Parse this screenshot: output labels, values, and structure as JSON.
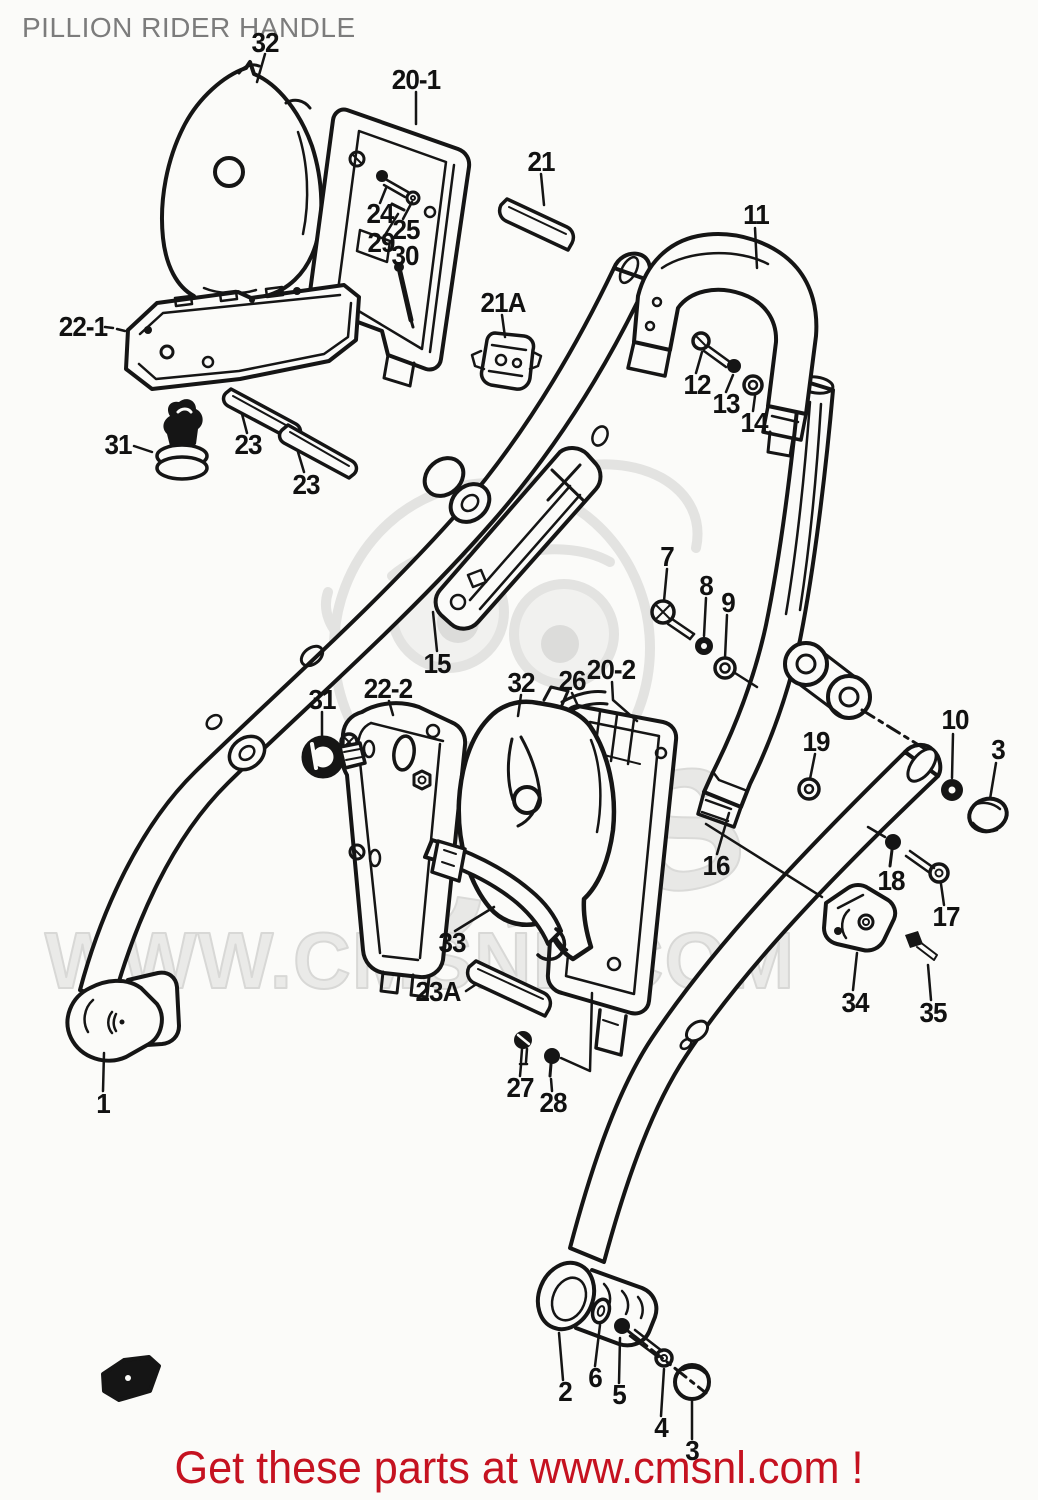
{
  "page": {
    "title": "PILLION RIDER HANDLE",
    "background": "#fbfbf9"
  },
  "colors": {
    "title_gray": "#7c7c7c",
    "line_black": "#151515",
    "footer_red": "#c51220",
    "watermark_gray": "#e4e4e2"
  },
  "watermark": {
    "logo_text": "CMS",
    "url_text": "WWW.CMSNL.COM"
  },
  "footer": {
    "text": "Get these parts at www.cmsnl.com !"
  },
  "diagram": {
    "description": "Exploded parts diagram of pillion rider handle assembly",
    "part_labels": [
      {
        "text": "32",
        "x": 265,
        "y": 43
      },
      {
        "text": "20-1",
        "x": 416,
        "y": 80
      },
      {
        "text": "24",
        "x": 380,
        "y": 214
      },
      {
        "text": "25",
        "x": 406,
        "y": 230
      },
      {
        "text": "29",
        "x": 381,
        "y": 243
      },
      {
        "text": "30",
        "x": 405,
        "y": 256
      },
      {
        "text": "21",
        "x": 541,
        "y": 162
      },
      {
        "text": "21A",
        "x": 503,
        "y": 303
      },
      {
        "text": "11",
        "x": 756,
        "y": 215
      },
      {
        "text": "12",
        "x": 697,
        "y": 385
      },
      {
        "text": "13",
        "x": 726,
        "y": 404
      },
      {
        "text": "14",
        "x": 754,
        "y": 423
      },
      {
        "text": "22-1",
        "x": 83,
        "y": 327
      },
      {
        "text": "31",
        "x": 118,
        "y": 445
      },
      {
        "text": "23",
        "x": 248,
        "y": 445
      },
      {
        "text": "23",
        "x": 306,
        "y": 485
      },
      {
        "text": "15",
        "x": 437,
        "y": 664
      },
      {
        "text": "7",
        "x": 667,
        "y": 557
      },
      {
        "text": "8",
        "x": 706,
        "y": 586
      },
      {
        "text": "9",
        "x": 728,
        "y": 603
      },
      {
        "text": "31",
        "x": 322,
        "y": 700
      },
      {
        "text": "22-2",
        "x": 388,
        "y": 689
      },
      {
        "text": "32",
        "x": 521,
        "y": 683
      },
      {
        "text": "26",
        "x": 572,
        "y": 681
      },
      {
        "text": "20-2",
        "x": 611,
        "y": 670
      },
      {
        "text": "19",
        "x": 816,
        "y": 742
      },
      {
        "text": "10",
        "x": 955,
        "y": 720
      },
      {
        "text": "3",
        "x": 998,
        "y": 750
      },
      {
        "text": "16",
        "x": 716,
        "y": 866
      },
      {
        "text": "18",
        "x": 891,
        "y": 881
      },
      {
        "text": "17",
        "x": 946,
        "y": 917
      },
      {
        "text": "34",
        "x": 855,
        "y": 1003
      },
      {
        "text": "35",
        "x": 933,
        "y": 1013
      },
      {
        "text": "33",
        "x": 452,
        "y": 943
      },
      {
        "text": "23A",
        "x": 438,
        "y": 992
      },
      {
        "text": "27",
        "x": 520,
        "y": 1088
      },
      {
        "text": "28",
        "x": 553,
        "y": 1103
      },
      {
        "text": "1",
        "x": 103,
        "y": 1104
      },
      {
        "text": "2",
        "x": 565,
        "y": 1392
      },
      {
        "text": "6",
        "x": 595,
        "y": 1378
      },
      {
        "text": "5",
        "x": 619,
        "y": 1395
      },
      {
        "text": "4",
        "x": 661,
        "y": 1428
      },
      {
        "text": "3",
        "x": 692,
        "y": 1451
      }
    ]
  }
}
